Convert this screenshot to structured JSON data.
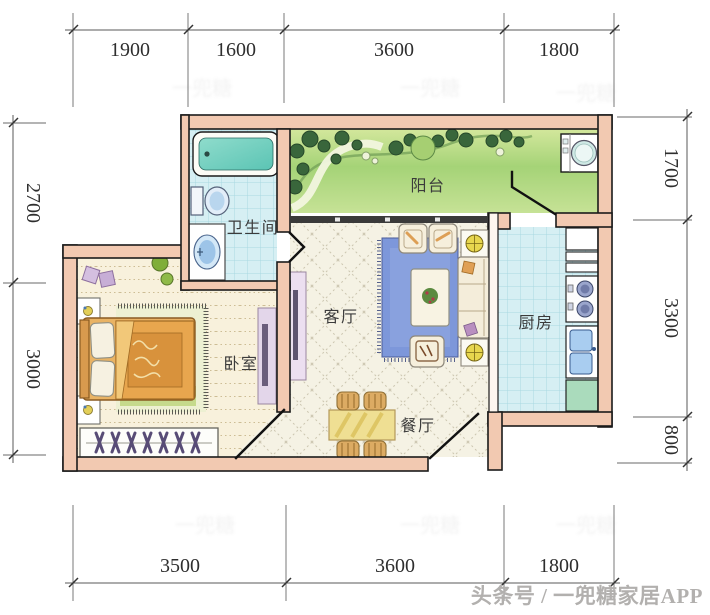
{
  "rooms": {
    "balcony": "阳台",
    "bathroom": "卫生间",
    "kitchen": "厨房",
    "living": "客厅",
    "bedroom": "卧室",
    "dining": "餐厅"
  },
  "dimensions": {
    "top": [
      "1900",
      "1600",
      "3600",
      "1800"
    ],
    "bottom": [
      "3500",
      "3600",
      "1800"
    ],
    "left": [
      "2700",
      "3000"
    ],
    "right": [
      "1700",
      "3300",
      "800"
    ]
  },
  "watermark": {
    "credit": "头条号 / 一兜糖家居APP",
    "faint": "一兜糖"
  },
  "colors": {
    "wall": "#f2c9b1",
    "tile": "#d6eff3",
    "balcony_green": "#aed77e",
    "bedroom_floor": "#f8f1dc",
    "living_floor": "#f5f2e4",
    "rug_blue": "#7d97da",
    "bed_orange": "#e9b364",
    "dining_table": "#efdf93"
  }
}
